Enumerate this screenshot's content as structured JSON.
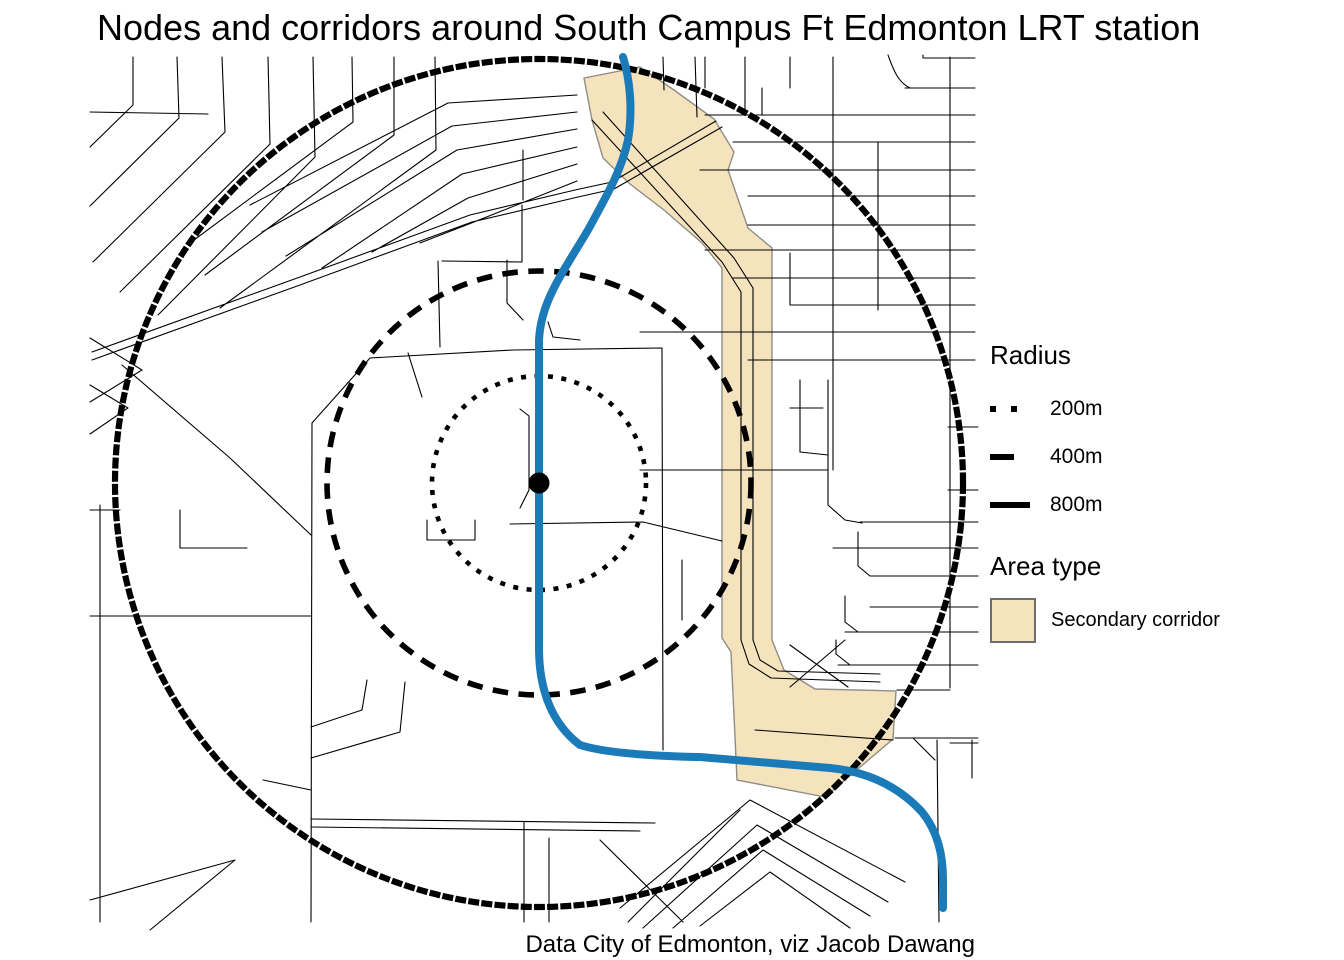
{
  "title": "Nodes and corridors around South Campus Ft Edmonton LRT station",
  "caption": "Data City of Edmonton, viz Jacob Dawang",
  "legend": {
    "radius_header": "Radius",
    "radius_items": [
      {
        "label": "200m",
        "style": "dotted"
      },
      {
        "label": "400m",
        "style": "dashed"
      },
      {
        "label": "800m",
        "style": "solid"
      }
    ],
    "area_header": "Area type",
    "area_items": [
      {
        "label": "Secondary corridor",
        "fill": "#f5e3bd"
      }
    ]
  },
  "map": {
    "rings": [
      {
        "radius_m": 200,
        "line_style": "dotted"
      },
      {
        "radius_m": 400,
        "line_style": "dashed"
      },
      {
        "radius_m": 800,
        "line_style": "solid"
      }
    ],
    "area_types": [
      {
        "name": "Secondary corridor",
        "fill": "#f5e3bd"
      }
    ],
    "colors": {
      "lrt_line": "#1b7ab8",
      "corridor_fill": "#f5e3bd",
      "corridor_stroke": "#8f8e86",
      "ring": "#000000",
      "road": "#000000",
      "station_dot": "#000000"
    }
  }
}
